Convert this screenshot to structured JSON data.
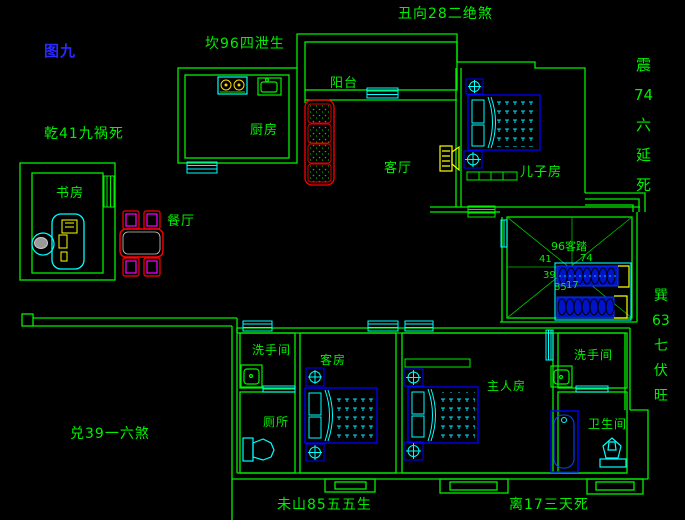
{
  "figure_label": "图九",
  "annotations": {
    "kan_north": "坎96四泄生",
    "chou_direction": "丑向28二绝煞",
    "qian_northwest": "乾41九祸死",
    "dui_west": "兑39一六煞",
    "wei_mountain": "未山85五五生",
    "li_south": "离17三天死",
    "zhen_east": [
      "震",
      "74",
      "六",
      "延",
      "死"
    ],
    "xun_southeast": [
      "巽",
      "63",
      "七",
      "伏",
      "旺"
    ]
  },
  "rooms": {
    "balcony": "阳台",
    "kitchen": "厨房",
    "living_room": "客厅",
    "dining_room": "餐厅",
    "study": "书房",
    "sons_room": "儿子房",
    "washroom_left": "洗手间",
    "toilet_room": "厕所",
    "guest_room": "客房",
    "master_room": "主人房",
    "washroom_right": "洗手间",
    "bathroom": "卫生间"
  },
  "center_diagram": {
    "label": "96客踏",
    "nw": "41",
    "ne": "74",
    "w": "39",
    "sw": "85",
    "se": "17"
  },
  "colors": {
    "background": "#000000",
    "walls": "#00F000",
    "fixtures": "#00FFFF",
    "beds": "#0000FF",
    "appliances": "#FFFF00",
    "sofa_dining": "#FF0000",
    "chair_accent": "#FF00FF",
    "figure_label": "#2A2AFF"
  }
}
